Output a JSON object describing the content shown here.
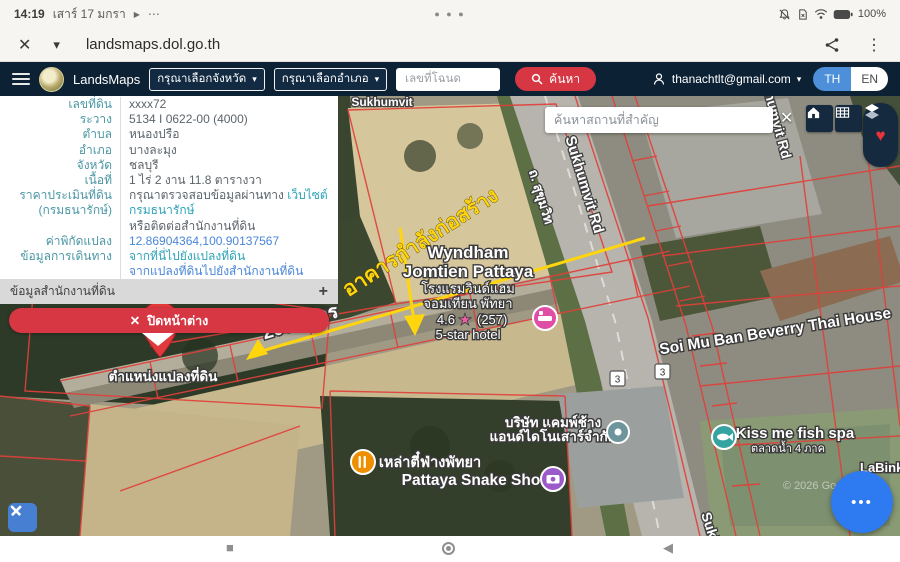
{
  "icons": {
    "close": "✕",
    "chevron_down": "▾",
    "play": "▶",
    "dots": "⋯",
    "kebab": "⋮",
    "heart": "♥",
    "plus": "+",
    "more": "•••",
    "square": "■",
    "back": "◀"
  },
  "status_bar": {
    "time": "14:19",
    "date": "เสาร์ 17 มกรา",
    "battery": "100%"
  },
  "browser": {
    "url": "landsmaps.dol.go.th"
  },
  "header": {
    "app_name": "LandsMaps",
    "province_dropdown": "กรุณาเลือกจังหวัด",
    "district_dropdown": "กรุณาเลือกอำเภอ",
    "deed_placeholder": "เลขที่โฉนด",
    "search_label": "ค้นหา",
    "account_email": "thanachtlt@gmail.com",
    "lang_th": "TH",
    "lang_en": "EN"
  },
  "panel": {
    "rows": [
      {
        "label": "เลขที่ดิน",
        "value": "xxxx72"
      },
      {
        "label": "ระวาง",
        "value": "5134 I 0622-00 (4000)"
      },
      {
        "label": "ตำบล",
        "value": "หนองปรือ"
      },
      {
        "label": "อำเภอ",
        "value": "บางละมุง"
      },
      {
        "label": "จังหวัด",
        "value": "ชลบุรี"
      },
      {
        "label": "เนื้อที่",
        "value": "1 ไร่ 2 งาน 11.8 ตารางวา"
      }
    ],
    "price_label_1": "ราคาประเมินที่ดิน",
    "price_label_2": "(กรมธนารักษ์)",
    "price_text": "กรุณาตรวจสอบข้อมูลผ่านทาง",
    "price_link": "เว็บไซต์กรมธนารักษ์",
    "price_text2": "หรือติดต่อสำนักงานที่ดิน",
    "coord_label": "ค่าพิกัดแปลง",
    "coord_value": "12.86904364,100.90137567",
    "travel_label": "ข้อมูลการเดินทาง",
    "travel_link1": "จากที่นี่ไปยังแปลงที่ดิน",
    "travel_link2": "จากแปลงที่ดินไปยังสำนักงานที่ดิน",
    "office_section": "ข้อมูลสำนักงานที่ดิน",
    "close_button": "ปิดหน้าต่าง"
  },
  "map": {
    "search_placeholder": "ค้นหาสถานที่สำคัญ",
    "pin_label": "ตำแหน่งแปลงที่ดิน",
    "annotation_building": "อาคารกำลังก่อสร้าง",
    "annotation_distance": "200 เมตร",
    "road_sukhumvit_en": "Sukhumvit Rd",
    "road_sukhumvit_th": "ถ. สุขุมวิท",
    "road_sukhumvit_short": "Sukhumvit",
    "route_number": "3",
    "watermark": "© 2026 Google",
    "poi": {
      "wyndham_line1": "Wyndham",
      "wyndham_line2": "Jomtien Pattaya",
      "wyndham_th1": "โรงแรมวินด์แฮม",
      "wyndham_th2": "จอมเทียน พัทยา",
      "wyndham_rating": "4.6",
      "wyndham_star": "★",
      "wyndham_count": "(257)",
      "wyndham_type": "5-star hotel",
      "soi": "Soi Mu Ban Beverry Thai House",
      "kissme": "Kiss me fish spa",
      "kissme_th": "ตลาดน้ำ 4 ภาค",
      "labink": "LaBink",
      "laoti": "เหล่าตี๋ฟ่างพัทยา",
      "snake": "Pattaya Snake Show",
      "camp_line1": "บริษัท แคมพ์ช้าง",
      "camp_line2": "แอนด์ไดโนเสาร์จำกัด"
    }
  }
}
